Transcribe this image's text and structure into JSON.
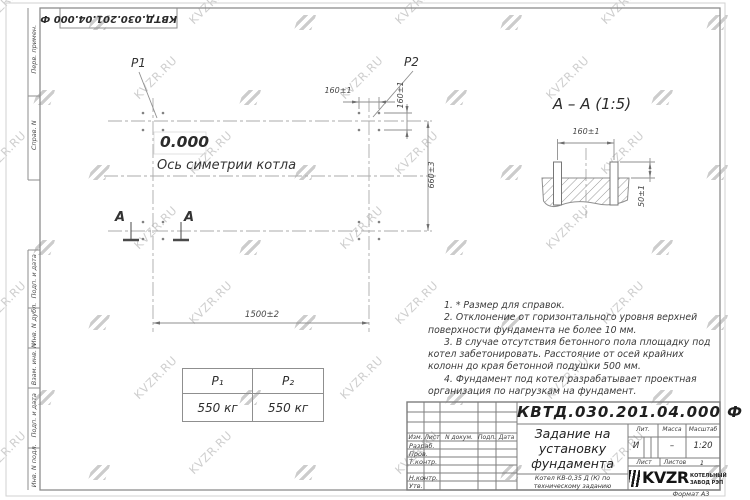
{
  "watermark": {
    "text": "KVZR.RU"
  },
  "stamp_top": "КВТД.030.201.04.000  Ф",
  "frame_left": {
    "items": [
      "Перв. примен.",
      "Справ. N",
      "Подп. и дата",
      "Инв. N дубл.",
      "Взам. инв. N",
      "Подп. и дата",
      "Инв. N подл."
    ]
  },
  "plan": {
    "p1_label": "P1",
    "p2_label": "P2",
    "elevation": "0.000",
    "axis_label": "Ось симетрии котла",
    "dim_160_top": "160±1",
    "dim_160_right": "160±1",
    "dim_660": "660±3",
    "dim_1500": "1500±2",
    "section_letter_1": "А",
    "section_letter_2": "А"
  },
  "section_view": {
    "title": "А – А (1:5)",
    "dim_160": "160±1",
    "dim_50": "50±1"
  },
  "notes": [
    "1. * Размер для справок.",
    "2. Отклонение от горизонтального уровня верхней поверхности фундамента не более 10 мм.",
    "3. В случае отсутствия бетонного пола площадку под котел забетонировать. Расстояние от осей крайних колонн до края бетонной подушки 500 мм.",
    "4. Фундамент под котел разрабатывает проектная организация по нагрузкам на фундамент."
  ],
  "load_table": {
    "headers": [
      "P₁",
      "P₂"
    ],
    "values": [
      "550 кг",
      "550 кг"
    ]
  },
  "title_block": {
    "doc_number": "КВТД.030.201.04.000  Ф",
    "title_lines": [
      "Задание на",
      "установку",
      "фундамента"
    ],
    "product_lines": [
      "Котел КВ-0,35 Д (К) по",
      "техническому заданию"
    ],
    "header_cols": [
      "Изм.",
      "Лист",
      "N докум.",
      "Подп.",
      "Дата"
    ],
    "sig_rows": [
      "Разраб.",
      "Пров.",
      "Т.контр.",
      "Н.контр.",
      "Утв."
    ],
    "lit_label": "Лит.",
    "lit_value": "И",
    "mass_label": "Масса",
    "mass_value": "–",
    "scale_label": "Масштаб",
    "scale_value": "1:20",
    "sheet_label": "Лист",
    "sheets_label": "Листов",
    "sheets_value": "1",
    "brand": "KVZR",
    "brand_line1": "КОТЕЛЬНЫЙ",
    "brand_line2": "ЗАВОД РЭП",
    "format_label": "Формат А3"
  }
}
